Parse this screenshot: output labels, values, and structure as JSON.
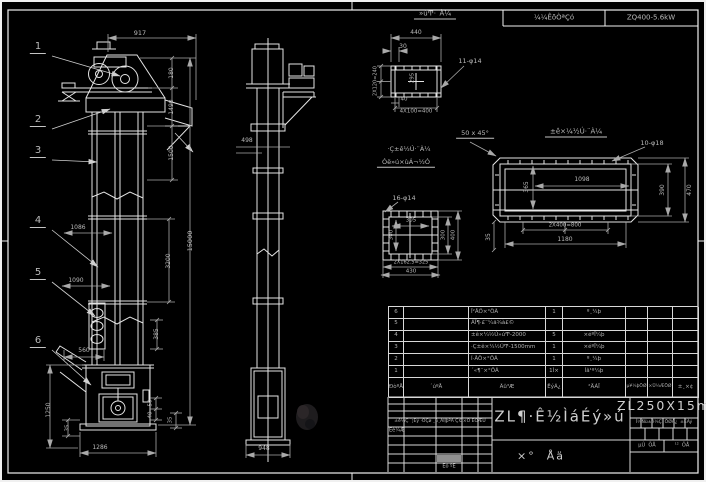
{
  "meta": {
    "background_color": "#000000",
    "line_color": "#e4e4e4",
    "dim_line_color": "#a9a9a9",
    "text_color": "#b9b9b9",
    "highlight_cell_color": "#8f8f8f",
    "sheet_model": "ZL250X15m"
  },
  "bom": {
    "headers": [
      "ÐòºÅ",
      "´úºÅ",
      "Ãû³Æ",
      "ÊýÁ¿",
      "²ÄÁÏ",
      "µ¥¼þÖØ",
      "×Ü¼ÆÖØ",
      "±¸×¢"
    ],
    "rows": [
      {
        "no": "6",
        "code": "",
        "name": "Î²ÂÖ×°ÖÃ",
        "qty": "1",
        "material": "º¸¼þ",
        "w1": "",
        "w2": "",
        "note": ""
      },
      {
        "no": "5",
        "code": "",
        "name": "ÁÏ¶·£¨¼ä¾à£©",
        "qty": "",
        "material": "",
        "w1": "",
        "w2": "",
        "note": ""
      },
      {
        "no": "4",
        "code": "",
        "name": "±ê×¼½Ú»úͲ-2000",
        "qty": "5",
        "material": "×éºÏ¼þ",
        "w1": "",
        "w2": "",
        "note": ""
      },
      {
        "no": "3",
        "code": "",
        "name": "·Ç±ê×¼½ÚͲ-1500mm",
        "qty": "1",
        "material": "×éºÏ¼þ",
        "w1": "",
        "w2": "",
        "note": ""
      },
      {
        "no": "2",
        "code": "",
        "name": "Í·ÂÖ×°ÖÃ",
        "qty": "1",
        "material": "º¸¼þ",
        "w1": "",
        "w2": "",
        "note": ""
      },
      {
        "no": "1",
        "code": "",
        "name": "´«¶¯×°ÖÃ",
        "qty": "1Ì×",
        "material": "Íâ¹º¼þ",
        "w1": "",
        "w2": "",
        "note": ""
      }
    ]
  },
  "texts": {
    "header_strip": [
      {
        "id": "header-cell-tech",
        "t": "¼¼ÊõÒªÇó",
        "x": 554,
        "y": 18,
        "s": 7
      },
      {
        "id": "header-cell-spec",
        "t": "ZQ400-5.6kW",
        "x": 651,
        "y": 18,
        "s": 7
      }
    ],
    "balloons": [
      {
        "id": "balloon-1",
        "t": "1",
        "x": 38,
        "y": 48,
        "s": 10,
        "u": 1
      },
      {
        "id": "balloon-2",
        "t": "2",
        "x": 38,
        "y": 121,
        "s": 10,
        "u": 1
      },
      {
        "id": "balloon-3",
        "t": "3",
        "x": 38,
        "y": 152,
        "s": 10,
        "u": 1
      },
      {
        "id": "balloon-4",
        "t": "4",
        "x": 38,
        "y": 222,
        "s": 10,
        "u": 1
      },
      {
        "id": "balloon-5",
        "t": "5",
        "x": 38,
        "y": 274,
        "s": 10,
        "u": 1
      },
      {
        "id": "balloon-6",
        "t": "6",
        "x": 38,
        "y": 342,
        "s": 10,
        "u": 1
      }
    ],
    "front_view_dims": [
      {
        "id": "dim-917",
        "t": "917",
        "x": 140,
        "y": 33,
        "s": 6.5
      },
      {
        "id": "dim-180",
        "t": "180",
        "x": 172,
        "y": 73,
        "s": 6,
        "r": 1
      },
      {
        "id": "dim-1490",
        "t": "1490",
        "x": 172,
        "y": 107,
        "s": 6,
        "r": 1
      },
      {
        "id": "dim-1500",
        "t": "1500",
        "x": 172,
        "y": 153,
        "s": 6,
        "r": 1
      },
      {
        "id": "dim-15000",
        "t": "15000",
        "x": 190,
        "y": 241,
        "s": 6.5,
        "r": 1
      },
      {
        "id": "dim-3200",
        "t": "3200",
        "x": 169,
        "y": 261,
        "s": 6,
        "r": 1
      },
      {
        "id": "dim-1086",
        "t": "1086",
        "x": 78,
        "y": 228,
        "s": 6
      },
      {
        "id": "dim-1090",
        "t": "1090",
        "x": 76,
        "y": 281,
        "s": 6
      },
      {
        "id": "dim-385",
        "t": "385",
        "x": 157,
        "y": 334,
        "s": 6,
        "r": 1
      },
      {
        "id": "dim-560",
        "t": "560",
        "x": 84,
        "y": 351,
        "s": 6
      },
      {
        "id": "dim-1250",
        "t": "1250",
        "x": 49,
        "y": 410,
        "s": 6,
        "r": 1
      },
      {
        "id": "dim-35-left",
        "t": "35",
        "x": 68,
        "y": 428,
        "s": 5.5,
        "r": 1
      },
      {
        "id": "dim-1286",
        "t": "1286",
        "x": 100,
        "y": 448,
        "s": 6
      },
      {
        "id": "dim-50",
        "t": "50",
        "x": 151,
        "y": 403,
        "s": 5.5,
        "r": 1
      },
      {
        "id": "dim-40",
        "t": "40",
        "x": 151,
        "y": 415,
        "s": 5.5,
        "r": 1
      },
      {
        "id": "dim-35-right",
        "t": "35",
        "x": 171,
        "y": 420,
        "s": 5.5,
        "r": 1
      }
    ],
    "side_view_dims": [
      {
        "id": "dim-498",
        "t": "498",
        "x": 247,
        "y": 141,
        "s": 6
      },
      {
        "id": "dim-948",
        "t": "948",
        "x": 264,
        "y": 449,
        "s": 6
      }
    ],
    "detail_flange_plate": [
      {
        "id": "detail-a-title",
        "t": "»úͲ·¨À¼",
        "x": 435,
        "y": 15,
        "s": 7,
        "u": 1
      },
      {
        "id": "flange-dim-440",
        "t": "440",
        "x": 416,
        "y": 33,
        "s": 6
      },
      {
        "id": "flange-dim-30",
        "t": "30",
        "x": 403,
        "y": 47,
        "s": 6
      },
      {
        "id": "flange-callout",
        "t": "11-φ14",
        "x": 470,
        "y": 61,
        "s": 6.5
      },
      {
        "id": "flange-dim-2x120",
        "t": "2X120=240",
        "x": 376,
        "y": 81,
        "s": 5,
        "r": 1
      },
      {
        "id": "flange-dim-295",
        "t": "295",
        "x": 413,
        "y": 78,
        "s": 5.5,
        "r": 1
      },
      {
        "id": "flange-dim-40",
        "t": "40",
        "x": 404,
        "y": 100,
        "s": 5.5
      },
      {
        "id": "flange-dim-4x100",
        "t": "4X100=400",
        "x": 416,
        "y": 112,
        "s": 5.5
      }
    ],
    "detail_square_flange": [
      {
        "id": "square-title-1",
        "t": "·Ç±ê½Ú·¨À¼",
        "x": 409,
        "y": 149,
        "s": 6.5
      },
      {
        "id": "square-title-2",
        "t": "Óë»ú×ùÁ¬½Ó",
        "x": 406,
        "y": 163,
        "s": 6.5,
        "u": 1
      },
      {
        "id": "square-callout",
        "t": "16-φ14",
        "x": 404,
        "y": 198,
        "s": 6.5
      },
      {
        "id": "square-dim-305",
        "t": "305",
        "x": 411,
        "y": 221,
        "s": 5.5
      },
      {
        "id": "square-dim-300",
        "t": "300",
        "x": 392,
        "y": 235,
        "s": 5.5,
        "r": 1
      },
      {
        "id": "square-dim-2x162",
        "t": "2X162.5=325",
        "x": 411,
        "y": 263,
        "s": 5
      },
      {
        "id": "square-dim-430",
        "t": "430",
        "x": 411,
        "y": 272,
        "s": 5.5
      },
      {
        "id": "square-dim-300r",
        "t": "300",
        "x": 444,
        "y": 235,
        "s": 5.5,
        "r": 1
      },
      {
        "id": "square-dim-400r",
        "t": "400",
        "x": 454,
        "y": 235,
        "s": 5.5,
        "r": 1
      }
    ],
    "detail_housing_flange": [
      {
        "id": "housing-title",
        "t": "±ê×¼½Ú·¨À¼",
        "x": 576,
        "y": 133,
        "s": 7,
        "u": 1
      },
      {
        "id": "chamfer-note",
        "t": "50 x 45°",
        "x": 475,
        "y": 134,
        "s": 6.5,
        "u": 1
      },
      {
        "id": "housing-callout",
        "t": "10-φ18",
        "x": 652,
        "y": 143,
        "s": 6.5
      },
      {
        "id": "housing-dim-1098",
        "t": "1098",
        "x": 582,
        "y": 180,
        "s": 6
      },
      {
        "id": "housing-dim-365",
        "t": "365",
        "x": 527,
        "y": 187,
        "s": 6,
        "r": 1
      },
      {
        "id": "housing-dim-390",
        "t": "390",
        "x": 663,
        "y": 190,
        "s": 6,
        "r": 1
      },
      {
        "id": "housing-dim-470",
        "t": "470",
        "x": 690,
        "y": 190,
        "s": 6,
        "r": 1
      },
      {
        "id": "housing-dim-2x400",
        "t": "2X400=800",
        "x": 565,
        "y": 226,
        "s": 5.5
      },
      {
        "id": "housing-dim-1180",
        "t": "1180",
        "x": 565,
        "y": 240,
        "s": 6
      },
      {
        "id": "housing-dim-35",
        "t": "35",
        "x": 489,
        "y": 237,
        "s": 6,
        "r": 1
      }
    ],
    "title_block": [
      {
        "id": "tb-revision-row",
        "t": "±ê¼Ç ´¦Êý ·ÖÇø ¸ü¸ÄÎļþºÅ Ç©×Ö ÈÕÆÚ",
        "x": 440,
        "y": 422,
        "s": 4.5
      },
      {
        "id": "tb-design",
        "t": "Éè¼Æ",
        "x": 397,
        "y": 431,
        "s": 5
      },
      {
        "id": "tb-approve",
        "t": "Éó ºË",
        "x": 449,
        "y": 467,
        "s": 5
      },
      {
        "id": "tb-title",
        "t": "ZL¶·Ê½ÌáÉý»ú",
        "x": 560,
        "y": 417,
        "s": 15,
        "big": 1
      },
      {
        "id": "tb-assembly",
        "t": "×°  Åä",
        "x": 541,
        "y": 456,
        "s": 11,
        "big": 1
      },
      {
        "id": "tb-model",
        "t": "ZL250X15m",
        "x": 664,
        "y": 406,
        "s": 12.5,
        "big": 1
      },
      {
        "id": "tb-right-headers",
        "t": "Í¼Ñù±ê¼Ç  ÖØÁ¿  ±ÈÀý",
        "x": 664,
        "y": 423,
        "s": 4.5
      },
      {
        "id": "tb-sheet-first",
        "t": "µÚ  ÕÅ",
        "x": 647,
        "y": 446,
        "s": 5
      },
      {
        "id": "tb-sheet-total",
        "t": "¹²  ÕÅ",
        "x": 682,
        "y": 446,
        "s": 5
      }
    ]
  }
}
